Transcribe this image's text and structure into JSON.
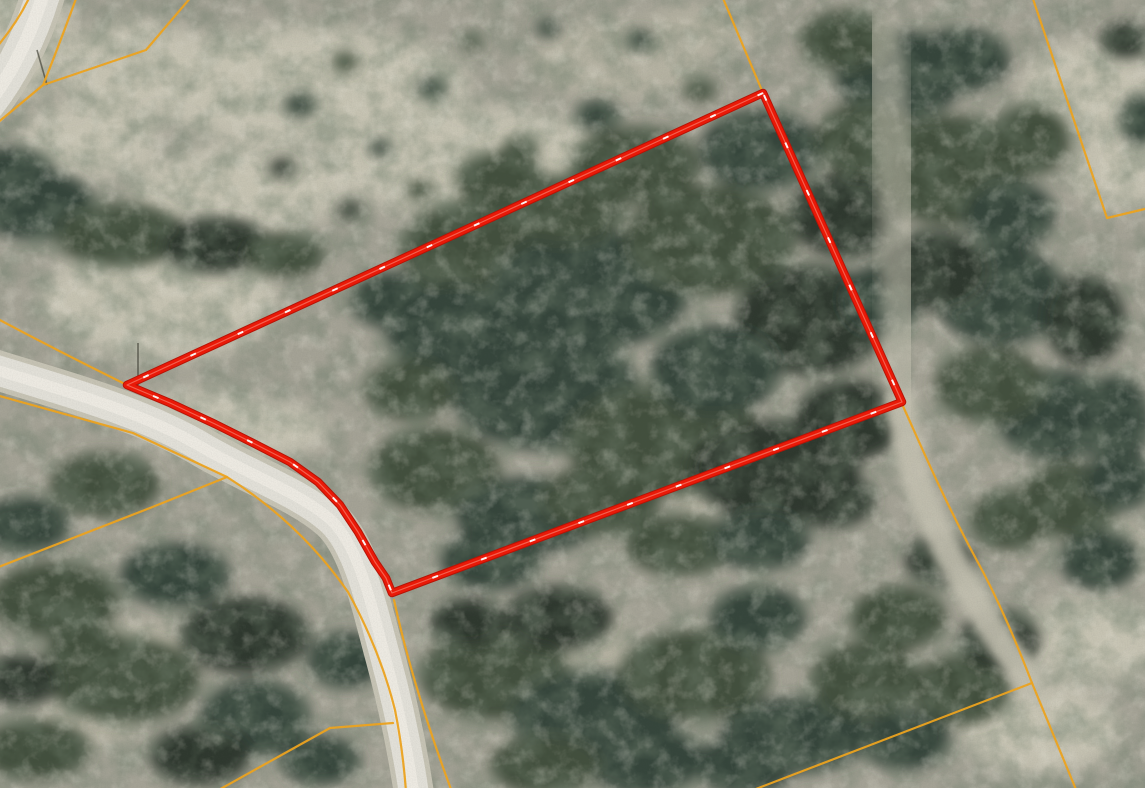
{
  "map": {
    "description": "aerial-imagery-parcel-map",
    "colors": {
      "highlight_outline": "#ed1806",
      "highlight_center_dash": "#ffffff",
      "boundary_line": "#efa41e",
      "road_surface": "#e2e0d8",
      "terrain_base": "#a4a295",
      "forest_canopy": "#3c4a39"
    },
    "geometry": {
      "red_parcel": "M763,93 L127,385 L170,403 L215,424 L255,444 L290,462 L318,482 L340,505 L358,532 L375,562 L386,578 L392,593 L902,402 Z",
      "road_top_left": "M45,-12 Q26,55 -12,104",
      "road_main": "M-10,368 C60,390 140,410 205,449 C258,479 302,494 331,520 C358,545 370,600 385,656 C398,704 407,746 414,794",
      "corridor_north": "M881,36 C896,150 904,280 902,402",
      "corridor_south": "M902,404 C906,470 938,540 974,598 C996,638 1014,660 1030,680",
      "orange_lines": [
        "M722,-4 L763,93",
        "M30,-4 Q18,22 -4,48",
        "M77,-4 Q58,48 43,85 Q18,106 -4,124",
        "M43,85 L146,50 L192,-4",
        "M-4,318 Q60,352 127,385",
        "M394,600 C404,646 420,706 452,792",
        "M-4,395 L133,433 L227,477 Q300,523 348,592 Q380,650 395,710 Q403,750 406,792",
        "M227,477 L150,508 L-4,568",
        "M393,723 L330,728 L215,792",
        "M902,404 C915,432 940,492 975,557 C1000,602 1018,647 1032,683 L1077,792",
        "M1032,683 L748,792",
        "M1032,-4 L1107,218 L1149,208"
      ],
      "pole_marks": [
        "M37,50 L47,85",
        "M138,343 L138,385"
      ]
    }
  }
}
